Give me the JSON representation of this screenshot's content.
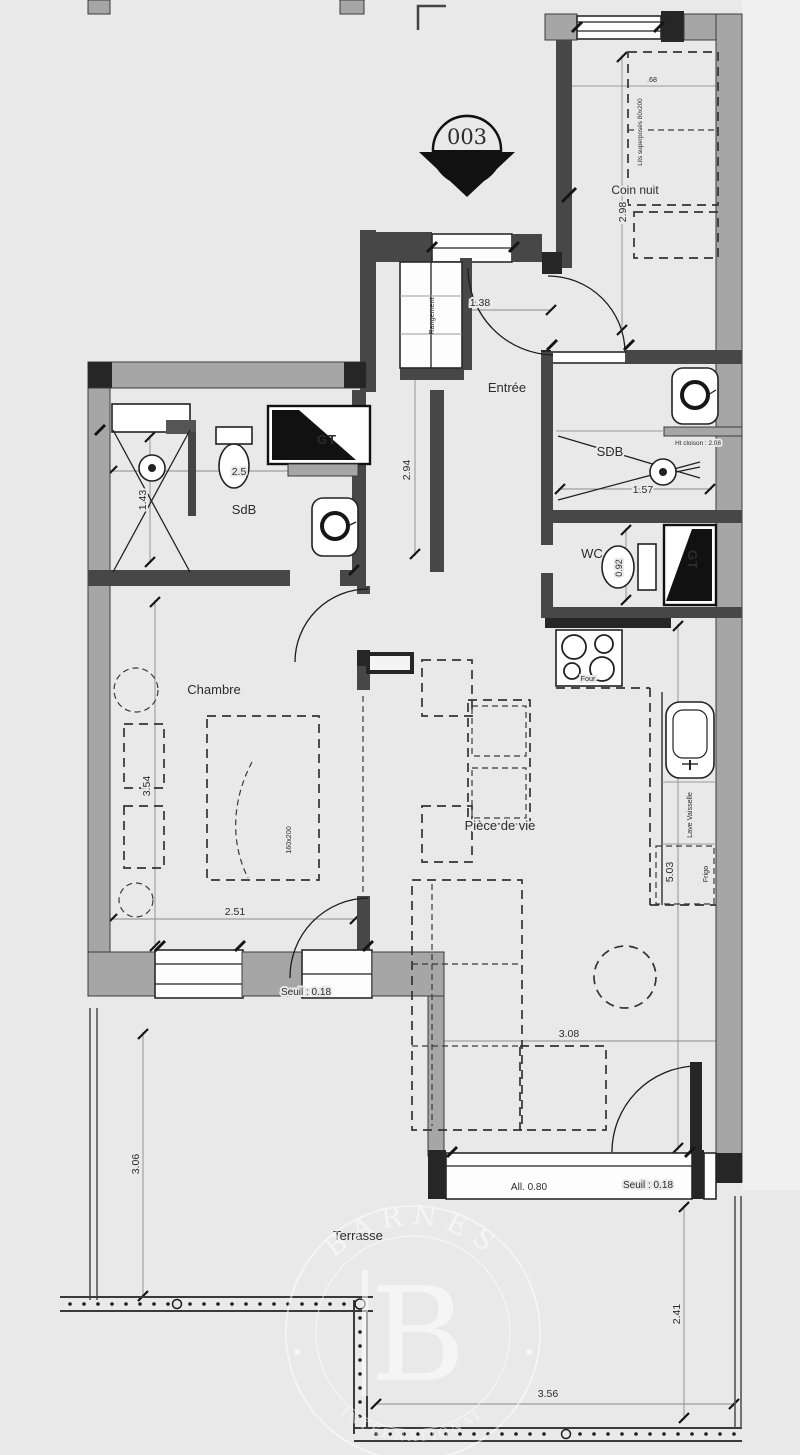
{
  "unit_marker": "003",
  "rooms": {
    "coin_nuit": "Coin nuit",
    "entree": "Entrée",
    "sdb_left": "SdB",
    "sdb_right": "SDB",
    "wc": "WC",
    "chambre": "Chambre",
    "piece_de_vie": "Pièce de vie",
    "terrasse": "Terrasse"
  },
  "fixtures": {
    "gt_left": "GT",
    "gt_right": "GT",
    "oven": "Four",
    "dishwasher": "Lave Vaisselle",
    "fridge": "Frigo",
    "closet": "Rangement",
    "bunk_bed": "Lits superposés 80x200",
    "double_bed": "160x200",
    "partition_note": "Ht cloison : 2.08"
  },
  "dimensions": {
    "entree": "1.38",
    "hallway": "2.94",
    "coin_nuit_length": "2.98",
    "coin_nuit_width": ".68",
    "sdb_left": "2.5",
    "shower": "1.43",
    "sdb_right": "1.57",
    "wc": "0.92",
    "chambre_length": "3.54",
    "chambre_width": "2.51",
    "sejour": "3.08",
    "kitchen_wall": "5.03",
    "terrasse_left": "3.06",
    "terrasse_right": "2.41",
    "terrasse_bottom": "3.56",
    "seuil_chambre": "Seuil : 0.18",
    "seuil_sejour": "Seuil : 0.18",
    "allege": "All. 0.80"
  },
  "watermark": {
    "brand": "BARNES",
    "initial": "B",
    "subtitle": "INTERNATIONAL"
  },
  "colors": {
    "background": "#e9e9e9",
    "wall_gray": "#a6a6a6",
    "wall_dark": "#474747",
    "line": "#2c2c2c"
  }
}
